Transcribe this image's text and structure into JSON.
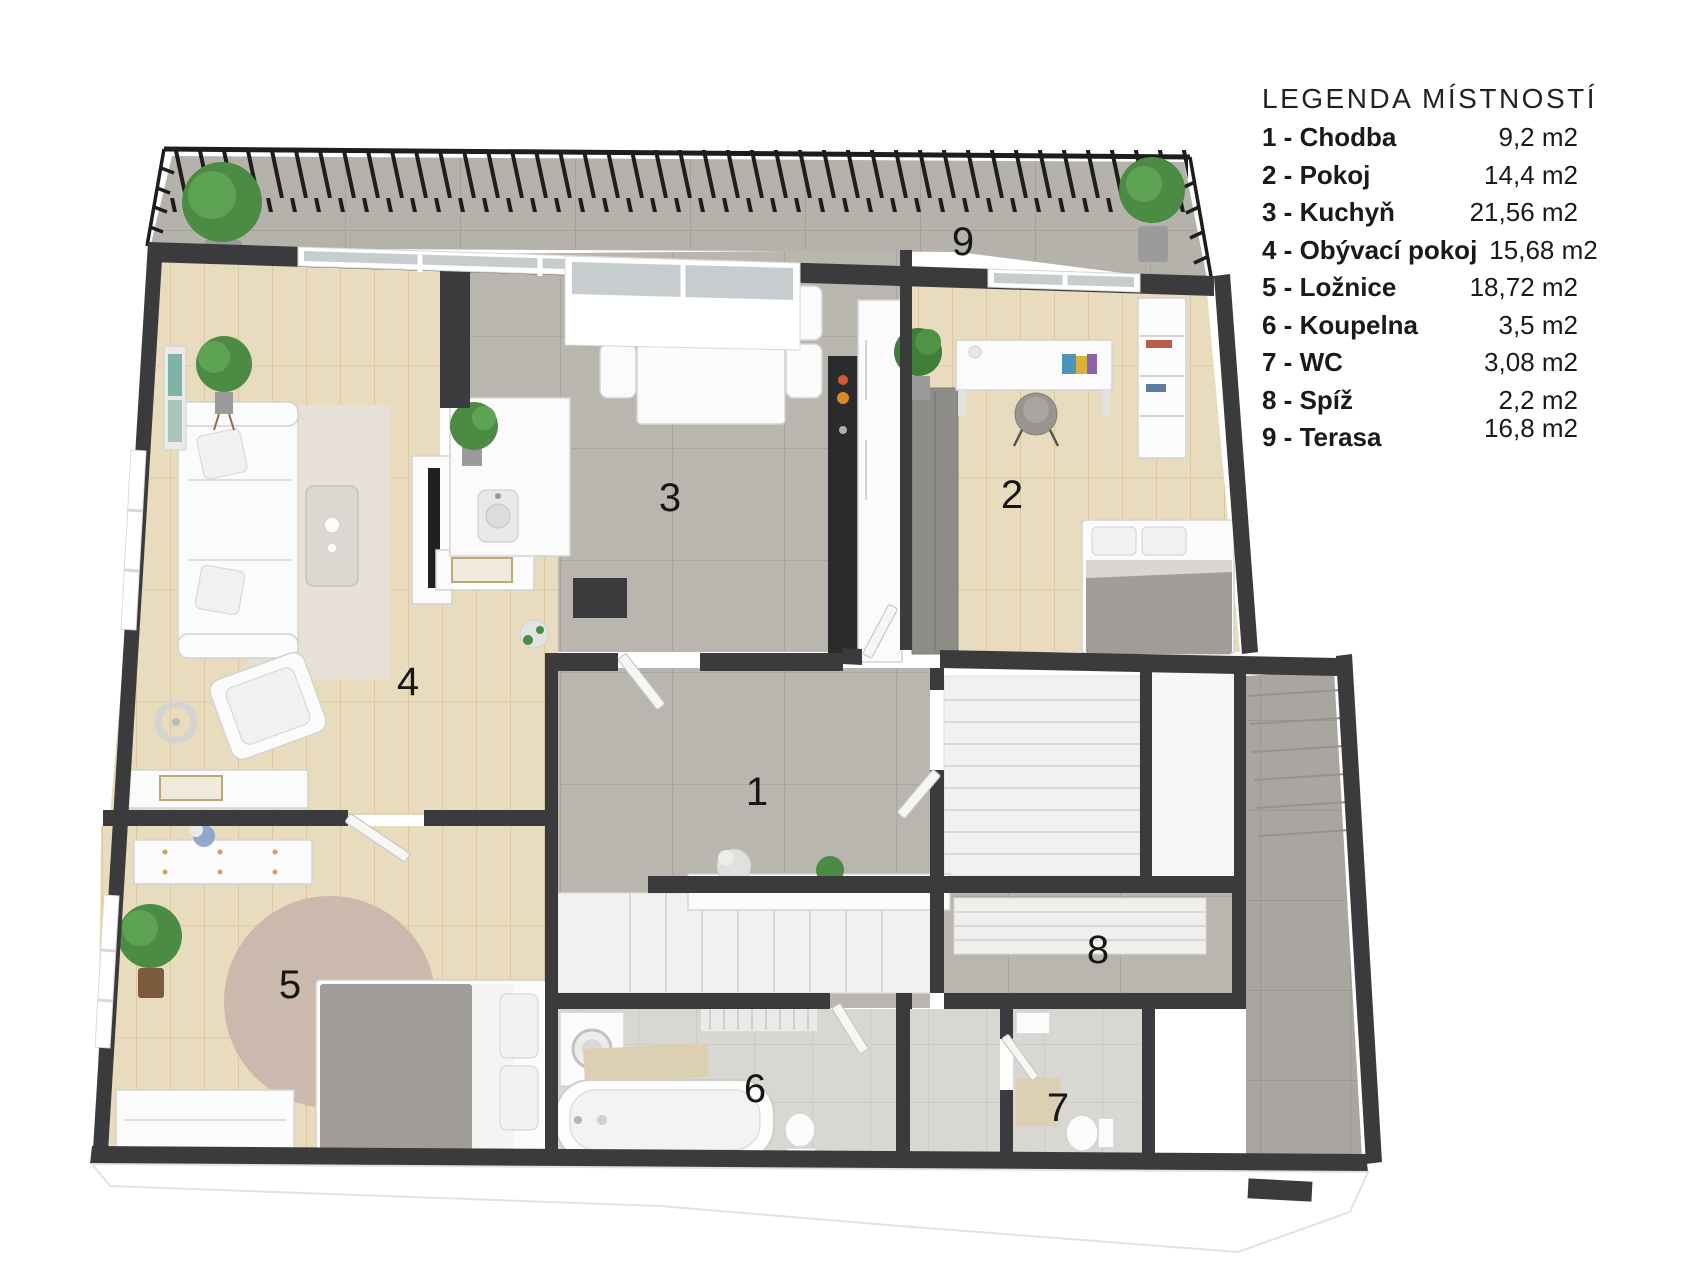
{
  "page": {
    "background": "#ffffff"
  },
  "theme": {
    "wall": "#3b3b3d",
    "railing": "#1d1d1d",
    "tile_gray": "#b9b6b0",
    "tile_terrace": "#b5b2ac",
    "tile_bath": "#d9d7d2",
    "tile_corridor": "#a9a6a1",
    "wood": "#e9dcbe",
    "rug_round": "#cbb9ad",
    "rug_living": "#e6e0d6",
    "furniture_white": "#fbfbfb",
    "bed_gray": "#a09c98",
    "wardrobe_gray": "#8e8c88",
    "kitchen_black": "#2b2b2d",
    "plant_green": "#4c8b43",
    "label_color": "#161616"
  },
  "legend": {
    "title": "LEGENDA MÍSTNOSTÍ",
    "rows": [
      {
        "label": "1 - Chodba",
        "area": "9,2 m2"
      },
      {
        "label": "2 - Pokoj",
        "area": "14,4 m2"
      },
      {
        "label": "3 - Kuchyň",
        "area": "21,56 m2"
      },
      {
        "label": "4 - Obývací pokoj",
        "area": "15,68 m2"
      },
      {
        "label": "5 - Ložnice",
        "area": "18,72 m2"
      },
      {
        "label": "6 - Koupelna",
        "area": "3,5 m2"
      },
      {
        "label": "7 - WC",
        "area": "3,08 m2"
      },
      {
        "label": "8 - Spíž",
        "area": "2,2 m2"
      },
      {
        "label": "9 - Terasa",
        "area": "16,8 m2"
      }
    ]
  },
  "plan": {
    "rooms": [
      {
        "num": "1",
        "name": "Chodba"
      },
      {
        "num": "2",
        "name": "Pokoj"
      },
      {
        "num": "3",
        "name": "Kuchyň"
      },
      {
        "num": "4",
        "name": "Obývací pokoj"
      },
      {
        "num": "5",
        "name": "Ložnice"
      },
      {
        "num": "6",
        "name": "Koupelna"
      },
      {
        "num": "7",
        "name": "WC"
      },
      {
        "num": "8",
        "name": "Spíž"
      },
      {
        "num": "9",
        "name": "Terasa"
      }
    ]
  }
}
